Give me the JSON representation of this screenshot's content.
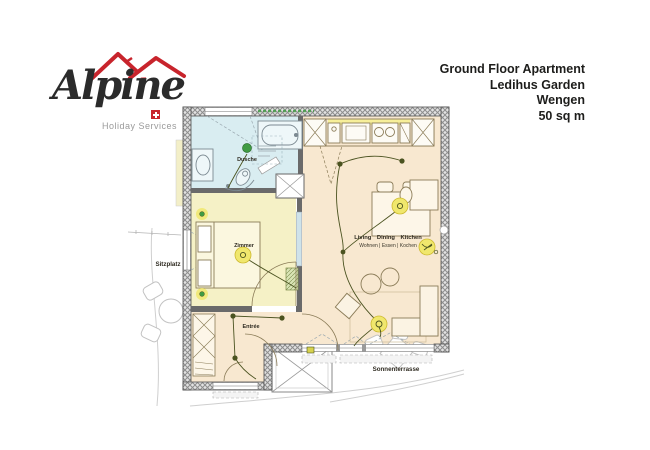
{
  "logo": {
    "brand": "Alpine",
    "tagline": "Holiday Services",
    "flag": "swiss-flag",
    "red": "#c8242c"
  },
  "title": {
    "lines": [
      "Ground Floor Apartment",
      "Ledihus Garden",
      "Wengen",
      "50 sq m"
    ]
  },
  "plan": {
    "rooms": {
      "bathroom": {
        "label": "Dusche",
        "fill": "#d9edf1"
      },
      "bedroom": {
        "label": "Zimmer",
        "fill": "#f5f1c6"
      },
      "living": {
        "label": "Living Dining Kitchen",
        "sublabel": "Wohnen | Essen | Kochen",
        "fill": "#f8e8d0"
      },
      "entry": {
        "label": "Entrée",
        "fill": "#f8e8d0"
      }
    },
    "outdoor": {
      "sitzplatz": "Sitzplatz",
      "sonnenterrasse": "Sonnenterrasse"
    },
    "colors": {
      "wall_hatch": "#8d8d8d",
      "light_yellow": "#f0e76d",
      "spot_olive": "#4b5320",
      "spot_green": "#3f9b42",
      "fixture_stroke": "#8b7c58",
      "sketch_gray": "#c2c2c2"
    }
  }
}
